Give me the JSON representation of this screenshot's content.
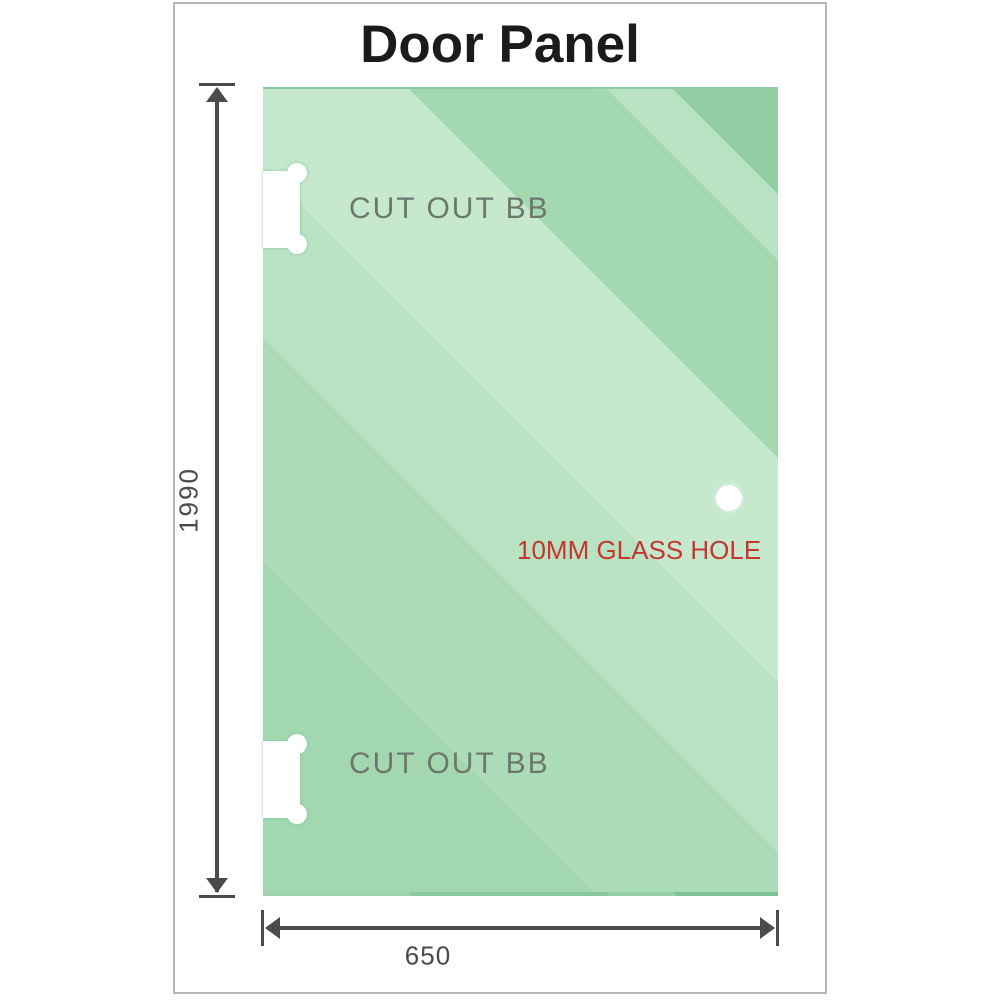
{
  "title": "Door Panel",
  "frame": {
    "border_color": "#b6b6b6"
  },
  "panel": {
    "glass_colors": {
      "base": "#abdcb7",
      "light_band": "#c6e8cd",
      "dark_band": "#93cfa5"
    },
    "cutout_top_label": "CUT OUT BB",
    "cutout_bottom_label": "CUT OUT BB",
    "hole_label": "10MM GLASS HOLE",
    "hole_label_color": "#c4372f"
  },
  "dimensions": {
    "height_value": "1990",
    "width_value": "650",
    "line_color": "#4b4b4b"
  }
}
